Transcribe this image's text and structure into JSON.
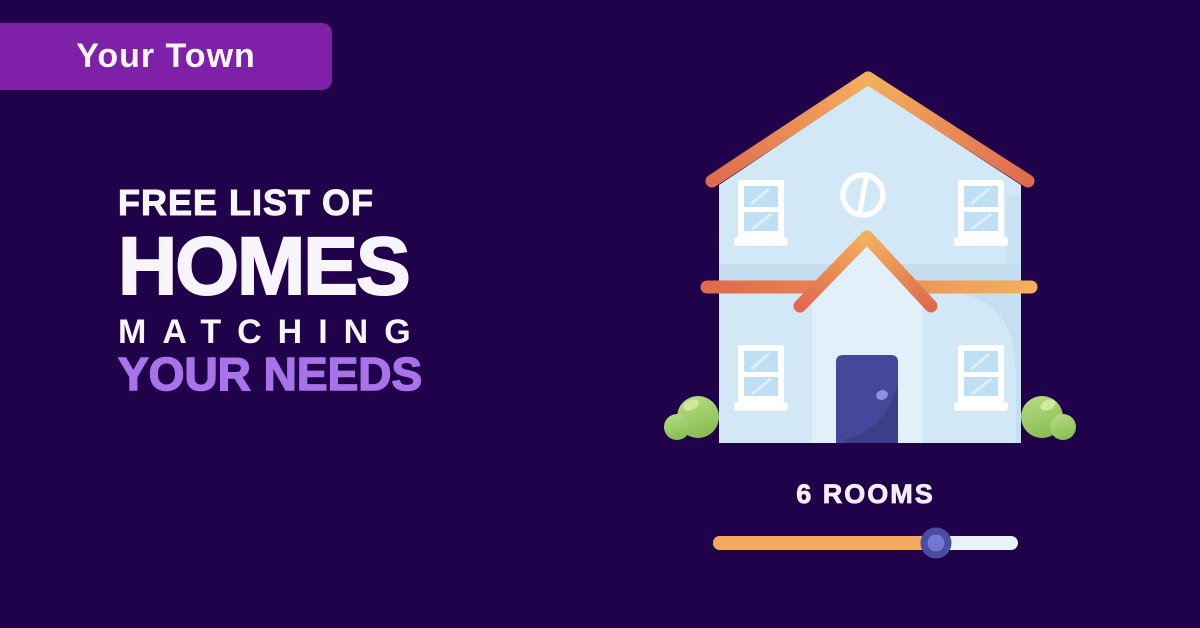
{
  "badge": {
    "label": "Your Town"
  },
  "headline": {
    "line1": "FREE LIST OF",
    "line2": "HOMES",
    "line3": "MATCHING",
    "line4": "YOUR NEEDS"
  },
  "room_selector": {
    "label": "6 ROOMS",
    "rooms_value": 6,
    "slider_fraction": 0.73
  },
  "illustration": {
    "description": "flat-style two-story house with orange gradient roof, round attic window, four sash windows, indigo front door and green bushes"
  },
  "colors": {
    "background": "#1f0249",
    "badge_bg": "#7e20a8",
    "badge_text": "#fdf6ff",
    "headline_white": "#f8f4fc",
    "headline_accent": "#a873e8",
    "rooms_text": "#f5edf4",
    "slider_fill": "#f1a95e",
    "slider_track": "#e7f2fa",
    "thumb_outer": "#4a4da1",
    "thumb_inner": "#7278d2",
    "house_body": "#d3e8f6",
    "house_shade": "#c3ddee",
    "porch_light": "#e2f0fa",
    "roof_yellow": "#f3b05c",
    "roof_red": "#e06a4e",
    "door": "#45479a",
    "door_shade": "#3c3e8a",
    "door_knob": "#8c90e2",
    "window_frame": "#ffffff",
    "window_pane": "#bfdff4",
    "bush_light": "#b8dd85",
    "bush_green": "#8abf55",
    "bush_highlight": "#d3ec9e"
  }
}
